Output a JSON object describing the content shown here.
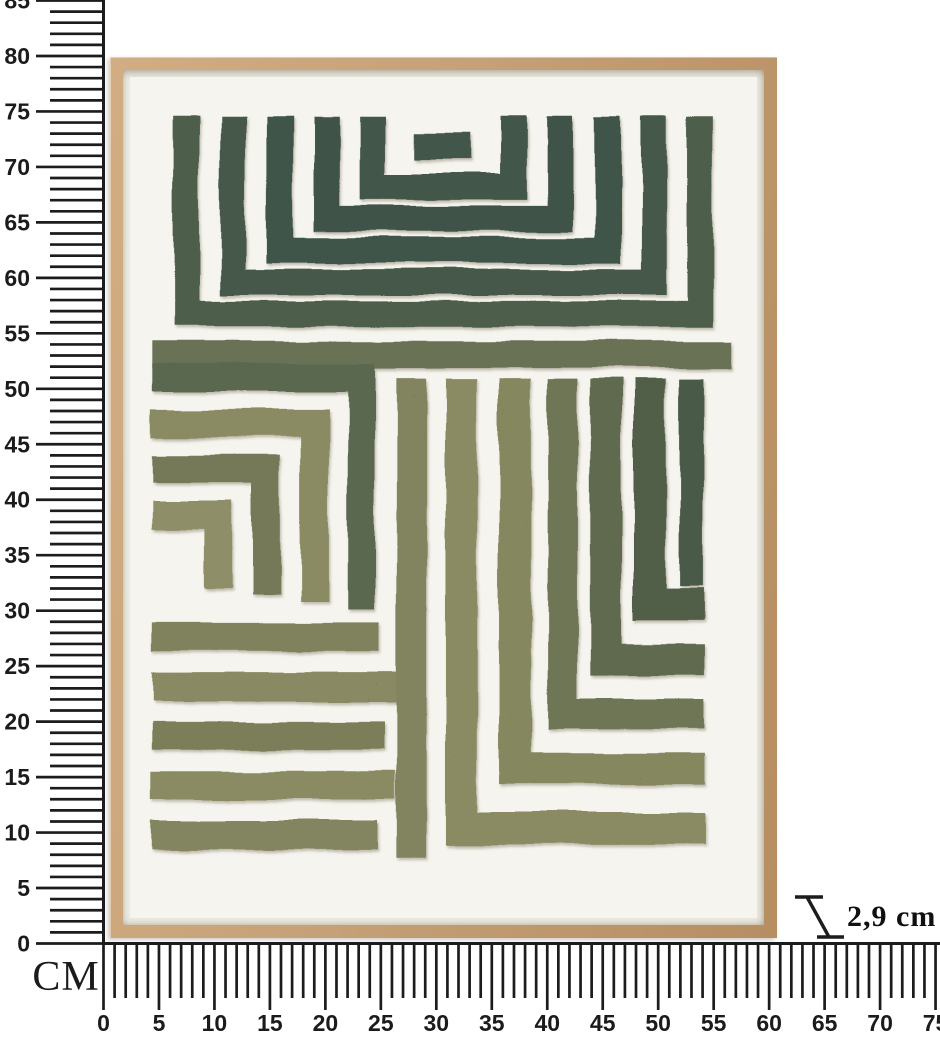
{
  "depth_annotation": {
    "value": "2,9 cm"
  },
  "rulers": {
    "unit_label": "CM",
    "tick_color": "#1c1c1c",
    "label_color": "#1b1b1b",
    "vertical": {
      "max_cm": 85,
      "label_step": 5,
      "px_per_cm": 11.094,
      "axis_x": 103.5,
      "origin_y": 943.5,
      "major_start_x": 36,
      "minor_start_x": 50,
      "labels": [
        0,
        5,
        10,
        15,
        20,
        25,
        30,
        35,
        40,
        45,
        50,
        55,
        60,
        65,
        70,
        75,
        80,
        85
      ]
    },
    "horizontal": {
      "max_cm": 75,
      "label_step": 5,
      "px_per_cm": 11.094,
      "axis_y": 943.5,
      "origin_x": 103.5,
      "major_end_y": 1010,
      "minor_end_y": 998,
      "label_y": 1031,
      "labels": [
        0,
        5,
        10,
        15,
        20,
        25,
        30,
        35,
        40,
        45,
        50,
        55,
        60,
        65,
        70,
        75
      ]
    }
  },
  "artwork": {
    "frame_color": "#c6a076",
    "gap_color": "#eceae1",
    "canvas_color": "#f5f4ee",
    "speckle_color": "#1e2d1d",
    "shadow_color": "#9a9180",
    "pattern": {
      "view_w": 632,
      "view_h": 845,
      "default_stroke_width": 26,
      "segments": [
        {
          "name": "top-u-ring-1",
          "d": "M57 40 V238 H575 V40",
          "c": "#4d5e4c"
        },
        {
          "name": "top-u-ring-2",
          "d": "M104 40 V206 H528 V40",
          "c": "#44584a"
        },
        {
          "name": "top-u-ring-3",
          "d": "M151 40 V174 H481 V40",
          "c": "#415449"
        },
        {
          "name": "top-u-ring-4",
          "d": "M198 40 V142 H434 V40",
          "c": "#3f5348"
        },
        {
          "name": "top-u-ring-5",
          "d": "M245 40 V110 H387 V40",
          "c": "#425649"
        },
        {
          "name": "top-center-bar",
          "d": "M288 70 H344",
          "c": "#43574a"
        },
        {
          "name": "divider-band",
          "d": "M22 279 H608",
          "c": "#6b7254",
          "w": 27
        },
        {
          "name": "left-corner-ring-1",
          "d": "M22 302 H233 V535",
          "c": "#5a6750",
          "w": 28
        },
        {
          "name": "left-corner-ring-2",
          "d": "M22 348 H185 V528",
          "c": "#8a8a63",
          "w": 28
        },
        {
          "name": "left-corner-ring-3",
          "d": "M22 394 H137 V521",
          "c": "#747959",
          "w": 28
        },
        {
          "name": "left-corner-ring-4",
          "d": "M22 440 H89 V514",
          "c": "#8e8e67",
          "w": 28
        },
        {
          "name": "bottom-left-stripe-1",
          "d": "M22 563 H252",
          "c": "#80825d",
          "w": 29
        },
        {
          "name": "bottom-left-stripe-2",
          "d": "M22 613 H270",
          "c": "#898963",
          "w": 29
        },
        {
          "name": "bottom-left-stripe-3",
          "d": "M22 662 H256",
          "c": "#7b7e5a",
          "w": 29
        },
        {
          "name": "bottom-left-stripe-4",
          "d": "M22 712 H268",
          "c": "#8a8a64",
          "w": 29
        },
        {
          "name": "bottom-left-stripe-5",
          "d": "M22 762 H250",
          "c": "#838460",
          "w": 29
        },
        {
          "name": "vertical-stripe-1",
          "d": "M284 303 V785",
          "c": "#81845f",
          "w": 30
        },
        {
          "name": "corner-stripe-2",
          "d": "M334 303 V755 H579",
          "c": "#8b8b64",
          "w": 32
        },
        {
          "name": "corner-stripe-3",
          "d": "M388 303 V695 H579",
          "c": "#85875f",
          "w": 32
        },
        {
          "name": "corner-stripe-4",
          "d": "M436 303 V640 H579",
          "c": "#6e7655",
          "w": 30
        },
        {
          "name": "corner-stripe-5",
          "d": "M480 303 V585 H579",
          "c": "#606b50",
          "w": 32
        },
        {
          "name": "corner-stripe-6",
          "d": "M524 303 V530 H579",
          "c": "#515f4a",
          "w": 32
        },
        {
          "name": "vertical-stripe-7",
          "d": "M566 303 V512",
          "c": "#4a5a49",
          "w": 24
        }
      ]
    }
  }
}
